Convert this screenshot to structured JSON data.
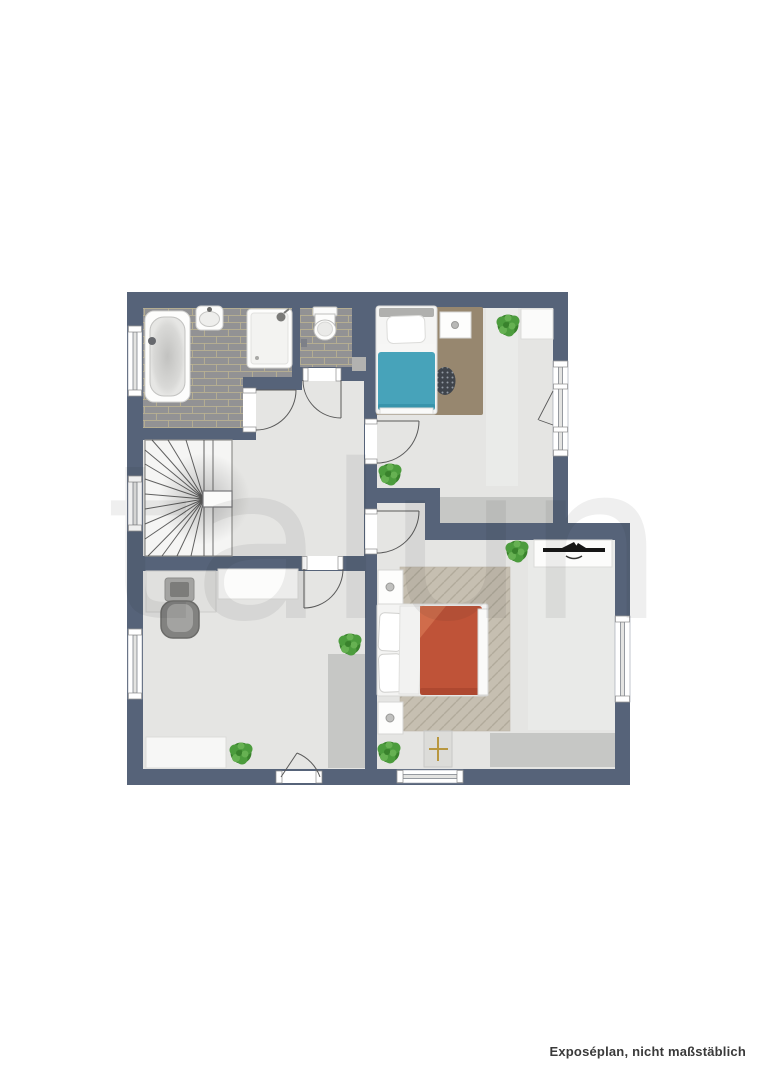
{
  "page": {
    "watermark": "talun",
    "disclaimer": "Exposéplan, nicht maßstäblich"
  },
  "colors": {
    "wall": "#566379",
    "floor": "#e5e5e3",
    "floor_sheen": "#edeeec",
    "tile": "#929294",
    "tile_grout": "#b9b192",
    "carpet_gray": "#c6c7c5",
    "counter_gray": "#b2b2b0",
    "rug_brown": "#97876f",
    "round_rug_dark": "#3f444b",
    "rug_beige": "#c6bfb1",
    "herringbone_line": "#b1aa9b",
    "bed_teal": "#47a3ba",
    "bed_red": "#bf5338",
    "plant_green": "#4c9c3d",
    "plant_green_dark": "#39822c",
    "plant_green_light": "#66b152",
    "tv_black": "#161616",
    "door_swing_line": "#5a5a5a",
    "stair_tread": "#474747",
    "watermark_gray": "#222222",
    "footer_text": "#3a3a3a"
  },
  "fixtures": {
    "bathroom": [
      "bathtub",
      "washbasin",
      "shower",
      "toilet"
    ],
    "hall": [
      "winder-staircase"
    ],
    "child_bedroom": [
      "single-bed-teal",
      "brown-rug",
      "round-dot-rug",
      "nightstand",
      "desk",
      "plant",
      "plant",
      "gray-carpet"
    ],
    "master_bedroom": [
      "double-bed-red",
      "herringbone-rug",
      "nightstand",
      "nightstand",
      "tv-sideboard",
      "television",
      "side-table",
      "plant",
      "plant",
      "gray-carpet"
    ],
    "study_room": [
      "desk",
      "monitor",
      "office-chair",
      "sideboard",
      "dresser",
      "wardrobe",
      "plant",
      "plant"
    ],
    "openings": [
      "window",
      "window",
      "window",
      "tilt-window",
      "window",
      "window",
      "door",
      "door",
      "door",
      "door",
      "door",
      "door"
    ]
  }
}
